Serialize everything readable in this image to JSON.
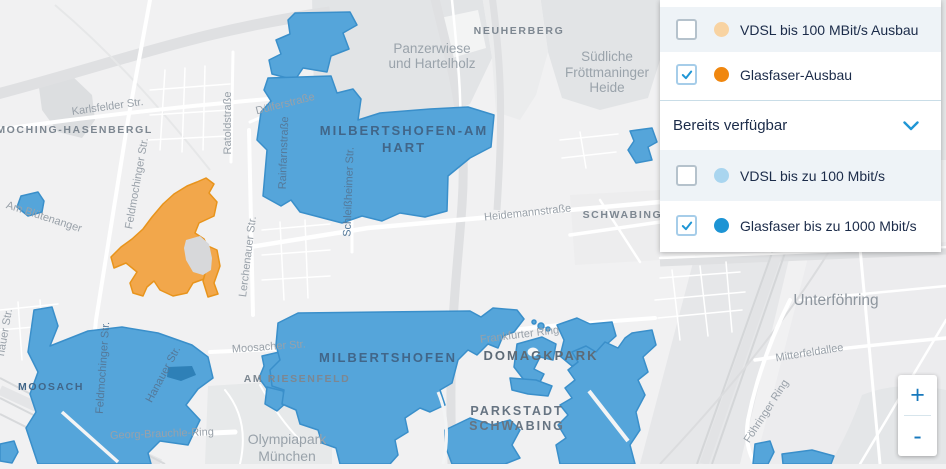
{
  "legend": {
    "section_header": {
      "label": "Bereits verfügbar"
    },
    "rows": [
      {
        "label": "VDSL bis 100 MBit/s Ausbau",
        "checked": false,
        "dot_color": "#f8d3a2",
        "shaded": true
      },
      {
        "label": "Glasfaser-Ausbau",
        "checked": true,
        "dot_color": "#f0870f",
        "shaded": false
      },
      {
        "label": "VDSL bis zu 100 Mbit/s",
        "checked": false,
        "dot_color": "#a9d5ef",
        "shaded": true
      },
      {
        "label": "Glasfaser bis zu 1000 Mbit/s",
        "checked": true,
        "dot_color": "#1d94d4",
        "shaded": false
      }
    ]
  },
  "zoom_controls": {
    "zoom_in": "+",
    "zoom_out": "-"
  },
  "colors": {
    "accent_blue": "#1f96d5",
    "coverage_blue": "#55a5da",
    "coverage_blue_border": "#3a8fca",
    "coverage_blue_dark": "#2e80b7",
    "coverage_orange": "#f2a74b",
    "coverage_orange_border": "#e8941c",
    "legend_text": "#1b2b49",
    "row_shade": "#eef3f7"
  },
  "map": {
    "labels": [
      {
        "text": "Karlsfelder Str.",
        "x": 108,
        "y": 110,
        "rot": -8,
        "style": "street"
      },
      {
        "text": "Am Blütenanger",
        "x": 43,
        "y": 220,
        "rot": 18,
        "style": "street"
      },
      {
        "text": "Feldmochinger Str.",
        "x": 140,
        "y": 184,
        "rot": -80,
        "style": "street"
      },
      {
        "text": "Ratoldstraße",
        "x": 231,
        "y": 123,
        "rot": -90,
        "style": "street"
      },
      {
        "text": "Dülferstraße",
        "x": 286,
        "y": 107,
        "rot": -14,
        "style": "street"
      },
      {
        "text": "Rainfarnstraße",
        "x": 287,
        "y": 153,
        "rot": -88,
        "style": "street-blue"
      },
      {
        "text": "Schleißheimer Str.",
        "x": 352,
        "y": 192,
        "rot": -88,
        "style": "street-blue"
      },
      {
        "text": "Heidemannstraße",
        "x": 528,
        "y": 216,
        "rot": -6,
        "style": "street"
      },
      {
        "text": "Lerchenauer Str.",
        "x": 251,
        "y": 257,
        "rot": -83,
        "style": "street"
      },
      {
        "text": "hauer Str.",
        "x": 8,
        "y": 333,
        "rot": -80,
        "style": "street"
      },
      {
        "text": "Feldmochinger Str.",
        "x": 106,
        "y": 368,
        "rot": -86,
        "style": "street-blue"
      },
      {
        "text": "Hanauer Str.",
        "x": 166,
        "y": 376,
        "rot": -62,
        "style": "street-blue"
      },
      {
        "text": "Moosacher Str.",
        "x": 269,
        "y": 350,
        "rot": -4,
        "style": "street"
      },
      {
        "text": "Georg-Brauchle-Ring",
        "x": 162,
        "y": 437,
        "rot": -2,
        "style": "street"
      },
      {
        "text": "Frankfurter Ring",
        "x": 520,
        "y": 338,
        "rot": -7,
        "style": "street"
      },
      {
        "text": "Mitterfeldallee",
        "x": 810,
        "y": 356,
        "rot": -9,
        "style": "street"
      },
      {
        "text": "Föhringer Ring",
        "x": 769,
        "y": 413,
        "rot": -57,
        "style": "street"
      },
      {
        "text": "LDMOCHING-HASENBERGL",
        "x": 66,
        "y": 133,
        "rot": 0,
        "style": "district"
      },
      {
        "text": "NEUHERBERG",
        "x": 519,
        "y": 34,
        "rot": 0,
        "style": "district"
      },
      {
        "text": "SCHWABING-",
        "x": 625,
        "y": 218,
        "rot": 0,
        "style": "district"
      },
      {
        "text": "AM RIESENFELD",
        "x": 297,
        "y": 382,
        "rot": 0,
        "style": "district"
      },
      {
        "text": "MOOSACH",
        "x": 51,
        "y": 390,
        "rot": 0,
        "style": "district-blue-sm"
      },
      {
        "text": "MILBERTSHOFEN-AM",
        "x": 404,
        "y": 135,
        "rot": 0,
        "style": "district-blue"
      },
      {
        "text": "HART",
        "x": 404,
        "y": 152,
        "rot": 0,
        "style": "district-blue"
      },
      {
        "text": "MILBERTSHOFEN",
        "x": 388,
        "y": 362,
        "rot": 0,
        "style": "district-blue"
      },
      {
        "text": "DOMAGKPARK",
        "x": 541,
        "y": 360,
        "rot": 0,
        "style": "district-lg"
      },
      {
        "text": "PARKSTADT",
        "x": 517,
        "y": 415,
        "rot": 0,
        "style": "district-lg2"
      },
      {
        "text": "SCHWABING",
        "x": 517,
        "y": 430,
        "rot": 0,
        "style": "district-lg2"
      },
      {
        "text": "Panzerwiese",
        "x": 432,
        "y": 53,
        "rot": 0,
        "style": "area"
      },
      {
        "text": "und Hartelholz",
        "x": 432,
        "y": 68,
        "rot": 0,
        "style": "area"
      },
      {
        "text": "Südliche",
        "x": 607,
        "y": 61,
        "rot": 0,
        "style": "area"
      },
      {
        "text": "Fröttmaninger",
        "x": 607,
        "y": 77,
        "rot": 0,
        "style": "area"
      },
      {
        "text": "Heide",
        "x": 607,
        "y": 92,
        "rot": 0,
        "style": "area"
      },
      {
        "text": "Olympiapark",
        "x": 287,
        "y": 444,
        "rot": 0,
        "style": "area-lg"
      },
      {
        "text": "München",
        "x": 287,
        "y": 461,
        "rot": 0,
        "style": "area-lg"
      },
      {
        "text": "Unterföhring",
        "x": 836,
        "y": 305,
        "rot": 0,
        "style": "area-xl"
      }
    ]
  }
}
